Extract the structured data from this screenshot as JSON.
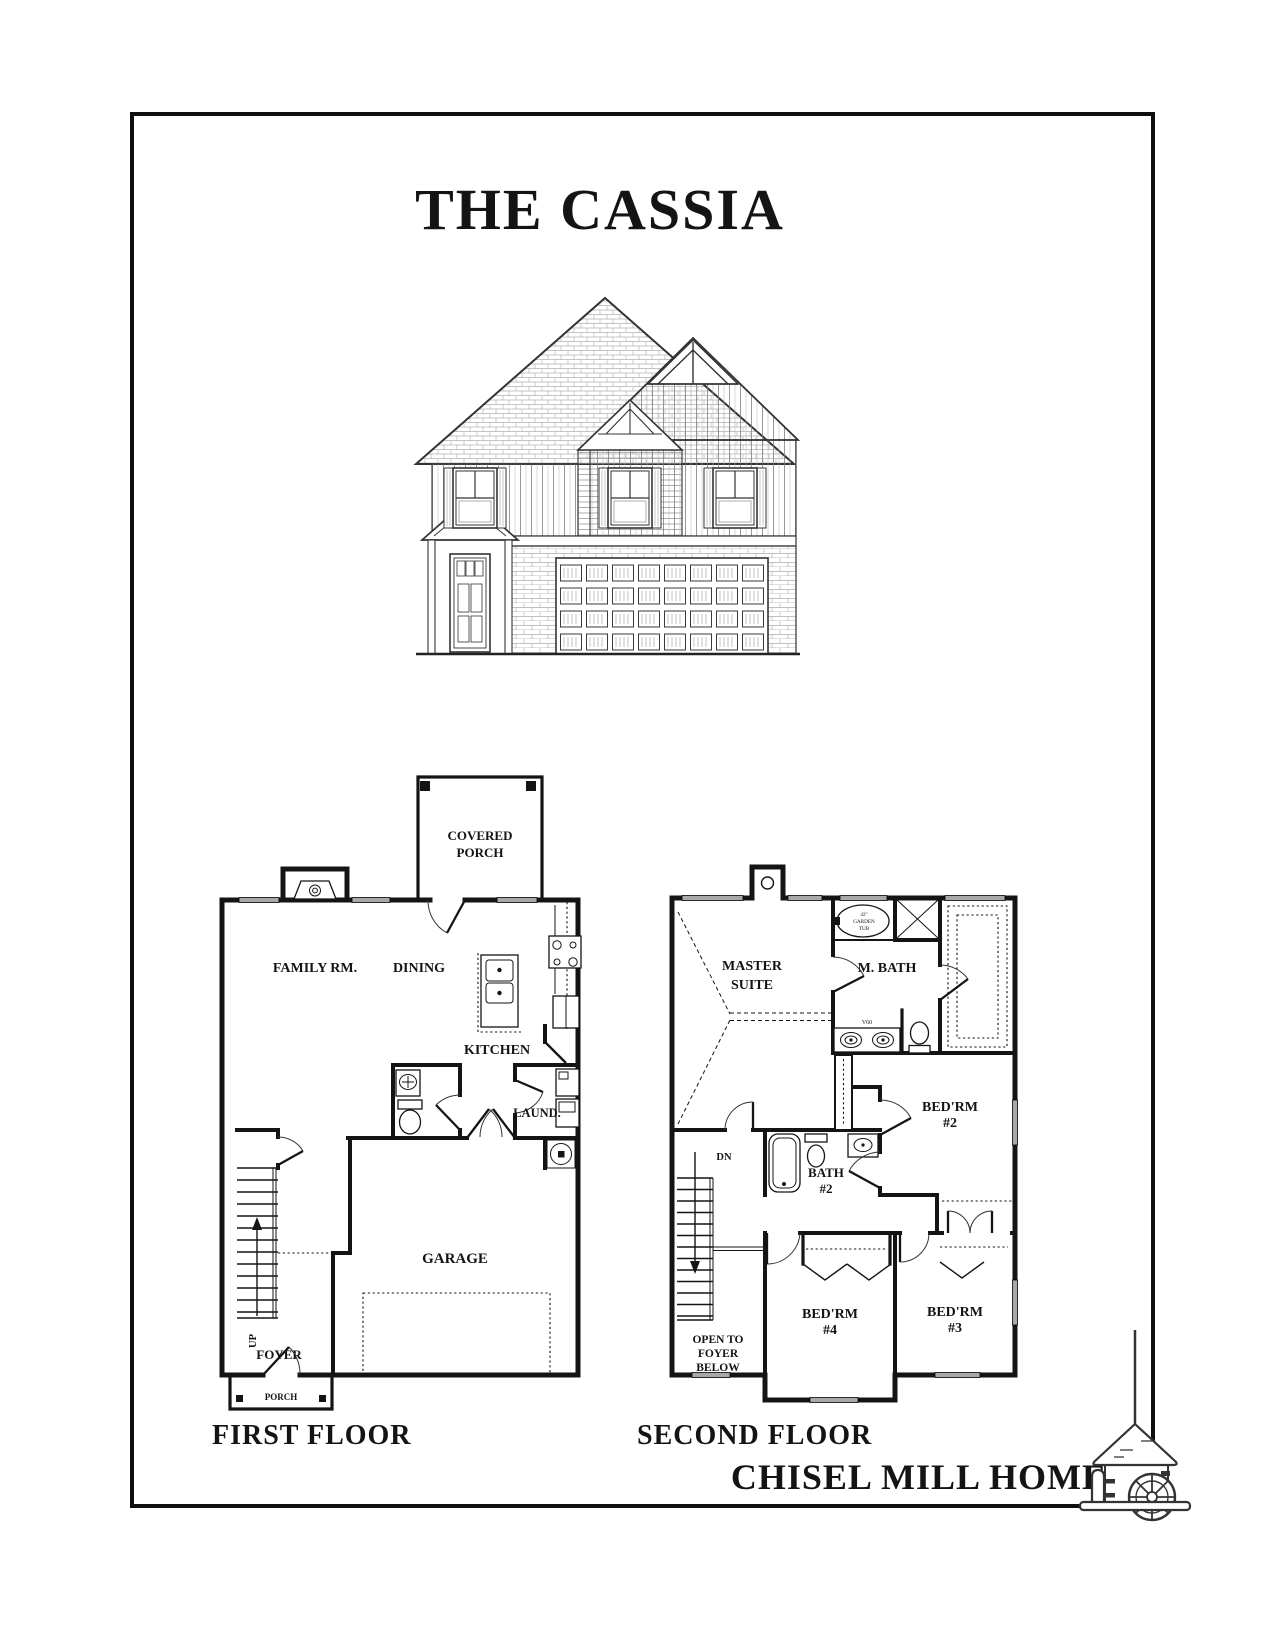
{
  "page": {
    "title": "THE CASSIA"
  },
  "floors": {
    "first": {
      "title": "FIRST FLOOR",
      "covered_porch": [
        "COVERED",
        "PORCH"
      ],
      "family_room": "FAMILY RM.",
      "dining": "DINING",
      "kitchen": "KITCHEN",
      "laundry": "LAUND.",
      "garage": "GARAGE",
      "foyer": "FOYER",
      "porch": "PORCH",
      "stairs_direction": "UP"
    },
    "second": {
      "title": "SECOND FLOOR",
      "master_suite": [
        "MASTER",
        "SUITE"
      ],
      "master_bath": "M. BATH",
      "garden_tub": [
        "42\"",
        "GARDEN",
        "TUB"
      ],
      "vanity": "V60",
      "bedroom2": [
        "BED'RM",
        "#2"
      ],
      "bath2": [
        "BATH",
        "#2"
      ],
      "bedroom3": [
        "BED'RM",
        "#3"
      ],
      "bedroom4": [
        "BED'RM",
        "#4"
      ],
      "open_to_foyer": [
        "OPEN TO",
        "FOYER",
        "BELOW"
      ],
      "stairs_direction": "DN"
    }
  },
  "footer": {
    "brand": "CHISEL MILL HOMES",
    "logo": "watermill-icon"
  },
  "style": {
    "ink": "#141414",
    "window_fill": "#a8a8a8",
    "paper": "#ffffff"
  }
}
